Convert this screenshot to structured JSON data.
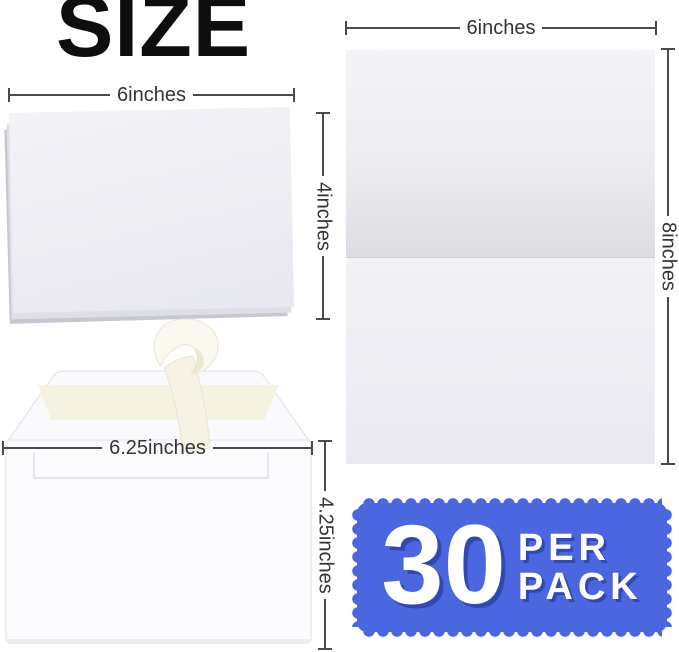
{
  "title": "SIZE",
  "folded_card": {
    "width_label": "6inches",
    "height_label": "4inches"
  },
  "flat_card": {
    "width_label": "6inches",
    "height_label": "8inches"
  },
  "envelope": {
    "width_label": "6.25inches",
    "height_label": "4.25inches"
  },
  "stamp": {
    "count": "30",
    "per": "PER",
    "pack": "PACK",
    "color": "#4b67e0"
  }
}
